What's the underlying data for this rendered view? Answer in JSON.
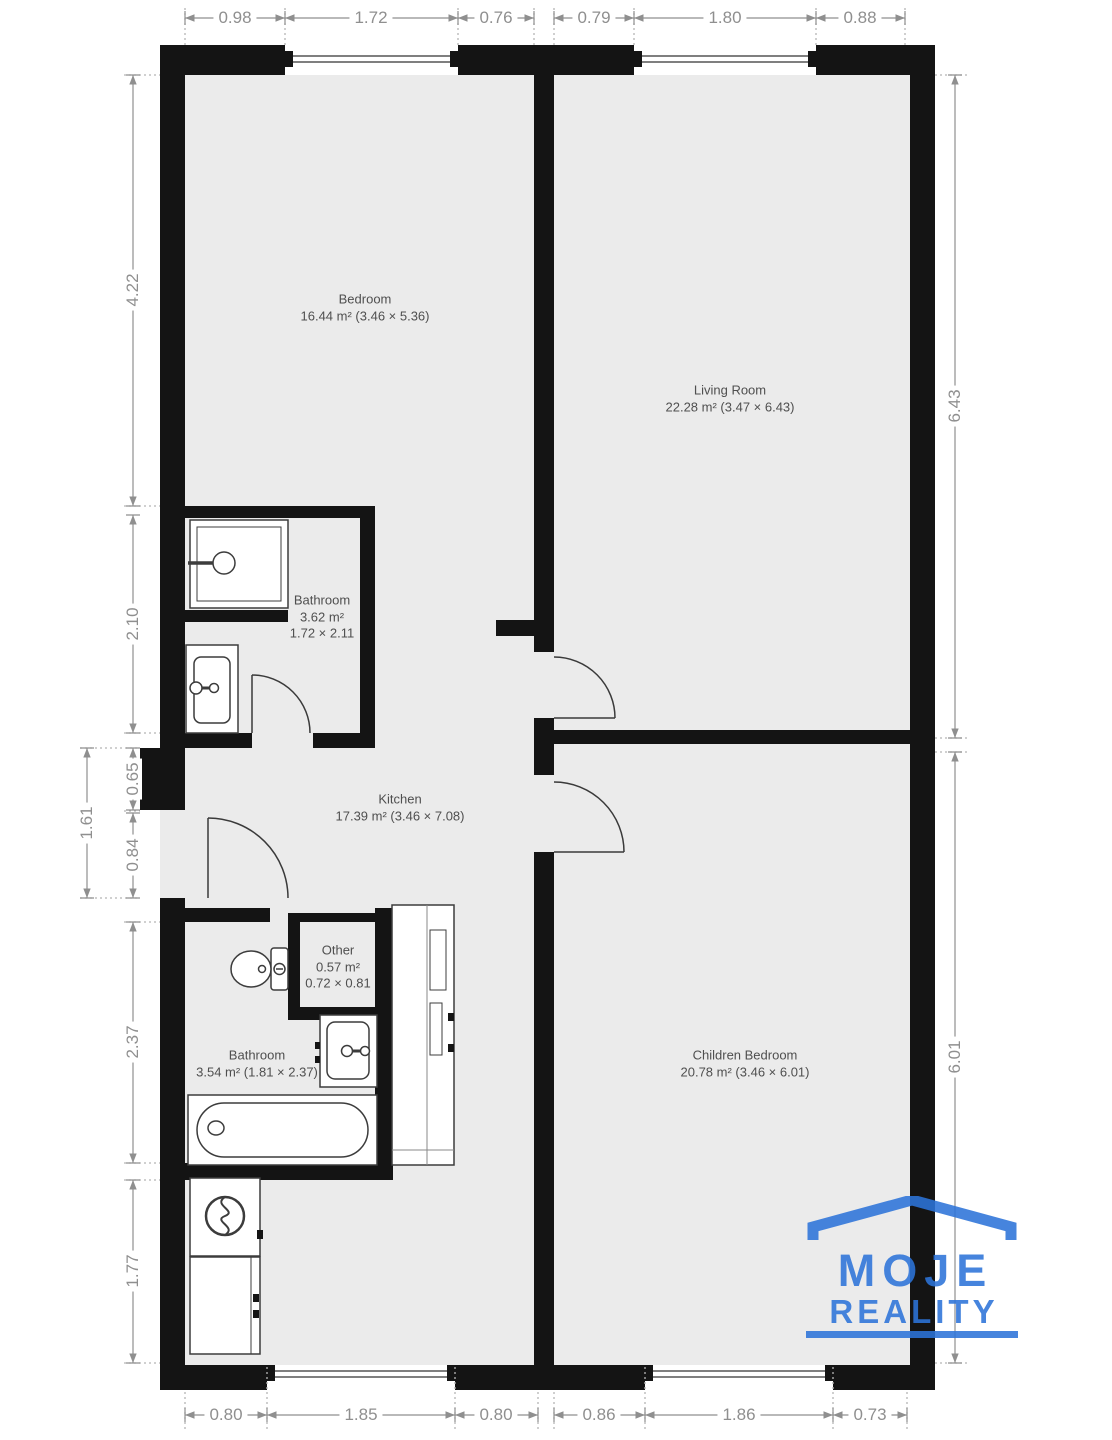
{
  "rooms": [
    {
      "name": "Bedroom",
      "area": "16.44 m² (3.46 × 5.36)"
    },
    {
      "name": "Living Room",
      "area": "22.28 m² (3.47 × 6.43)"
    },
    {
      "name": "Bathroom",
      "area": "3.62 m²",
      "size": "1.72 × 2.11"
    },
    {
      "name": "Kitchen",
      "area": "17.39 m² (3.46 × 7.08)"
    },
    {
      "name": "Other",
      "area": "0.57 m²",
      "size": "0.72 × 0.81"
    },
    {
      "name": "Bathroom",
      "area": "3.54 m² (1.81 × 2.37)"
    },
    {
      "name": "Children Bedroom",
      "area": "20.78 m² (3.46 × 6.01)"
    }
  ],
  "dimensions": {
    "top": [
      "0.98",
      "1.72",
      "0.76",
      "0.79",
      "1.80",
      "0.88"
    ],
    "bottom": [
      "0.80",
      "1.85",
      "0.80",
      "0.86",
      "1.86",
      "0.73"
    ],
    "left": [
      "4.22",
      "2.10",
      "2.37",
      "1.77"
    ],
    "left_inner": [
      "0.65",
      "0.84"
    ],
    "left_outer": [
      "1.61"
    ],
    "right": [
      "6.43",
      "6.01"
    ]
  },
  "logo": {
    "line1": "MOJE",
    "line2": "REALITY"
  },
  "colors": {
    "logo_blue": "#2d74d9",
    "wall": "#141414",
    "floor": "#ebebeb",
    "dimension": "#8f8f8f",
    "label": "#4f4f4f"
  }
}
